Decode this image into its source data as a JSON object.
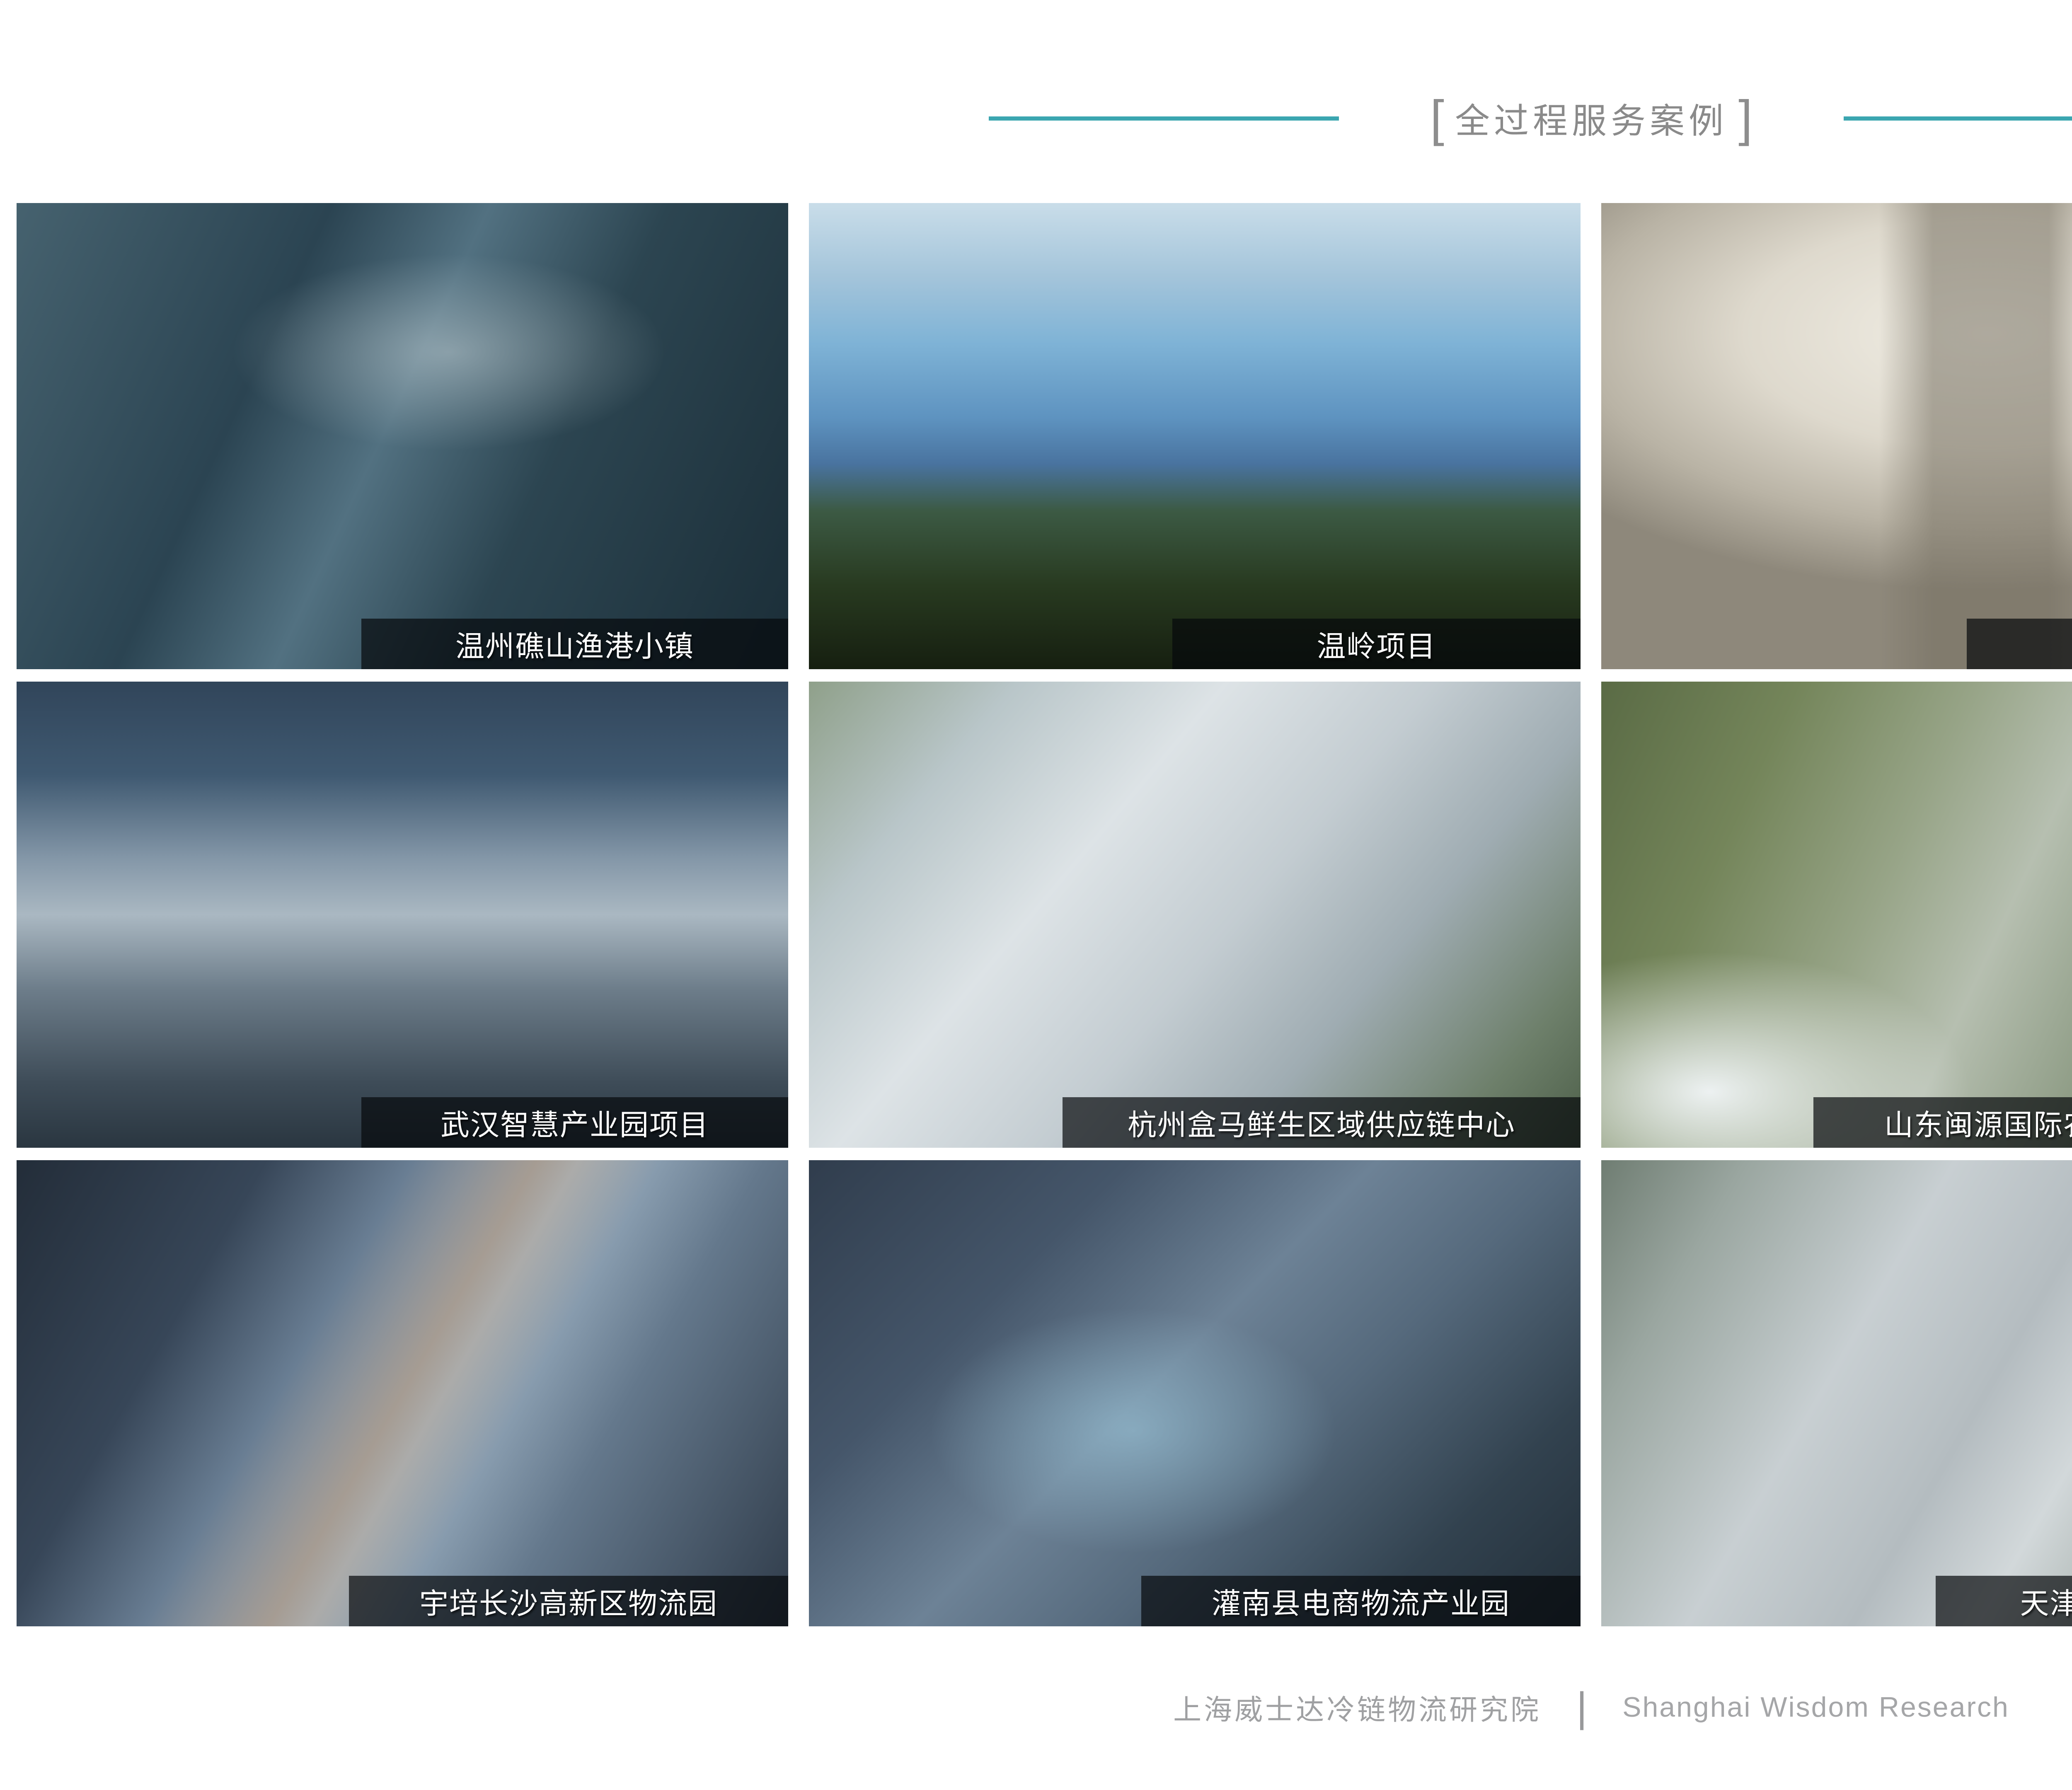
{
  "header": {
    "bracket_left": "[",
    "title": "全过程服务案例",
    "bracket_right": "]"
  },
  "projects": [
    {
      "caption": "温州礁山渔港小镇"
    },
    {
      "caption": "温岭项目"
    },
    {
      "caption": "上海金山项目"
    },
    {
      "caption": "舟山渔港项目"
    },
    {
      "caption": "武汉智慧产业园项目"
    },
    {
      "caption": "杭州盒马鲜生区域供应链中心"
    },
    {
      "caption": "山东闽源国际农产品物流产业园"
    },
    {
      "caption": "湖州农副产品物流集散中心"
    },
    {
      "caption": "宇培长沙高新区物流园"
    },
    {
      "caption": "灌南县电商物流产业园"
    },
    {
      "caption": "天津农产品加工项目"
    },
    {
      "caption": "长春市北湖冷链物流产业园"
    }
  ],
  "footer": {
    "cn_name": "上海威士达冷链物流研究院",
    "divider": "|",
    "en_name": "Shanghai Wisdom Research"
  },
  "colors": {
    "accent_teal": "#3BA6B0",
    "title_gray": "#8A8A8A",
    "footer_gray": "#9FA0A2",
    "caption_text": "#FFFFFF",
    "caption_bar": "rgba(6,9,11,0.70)"
  }
}
